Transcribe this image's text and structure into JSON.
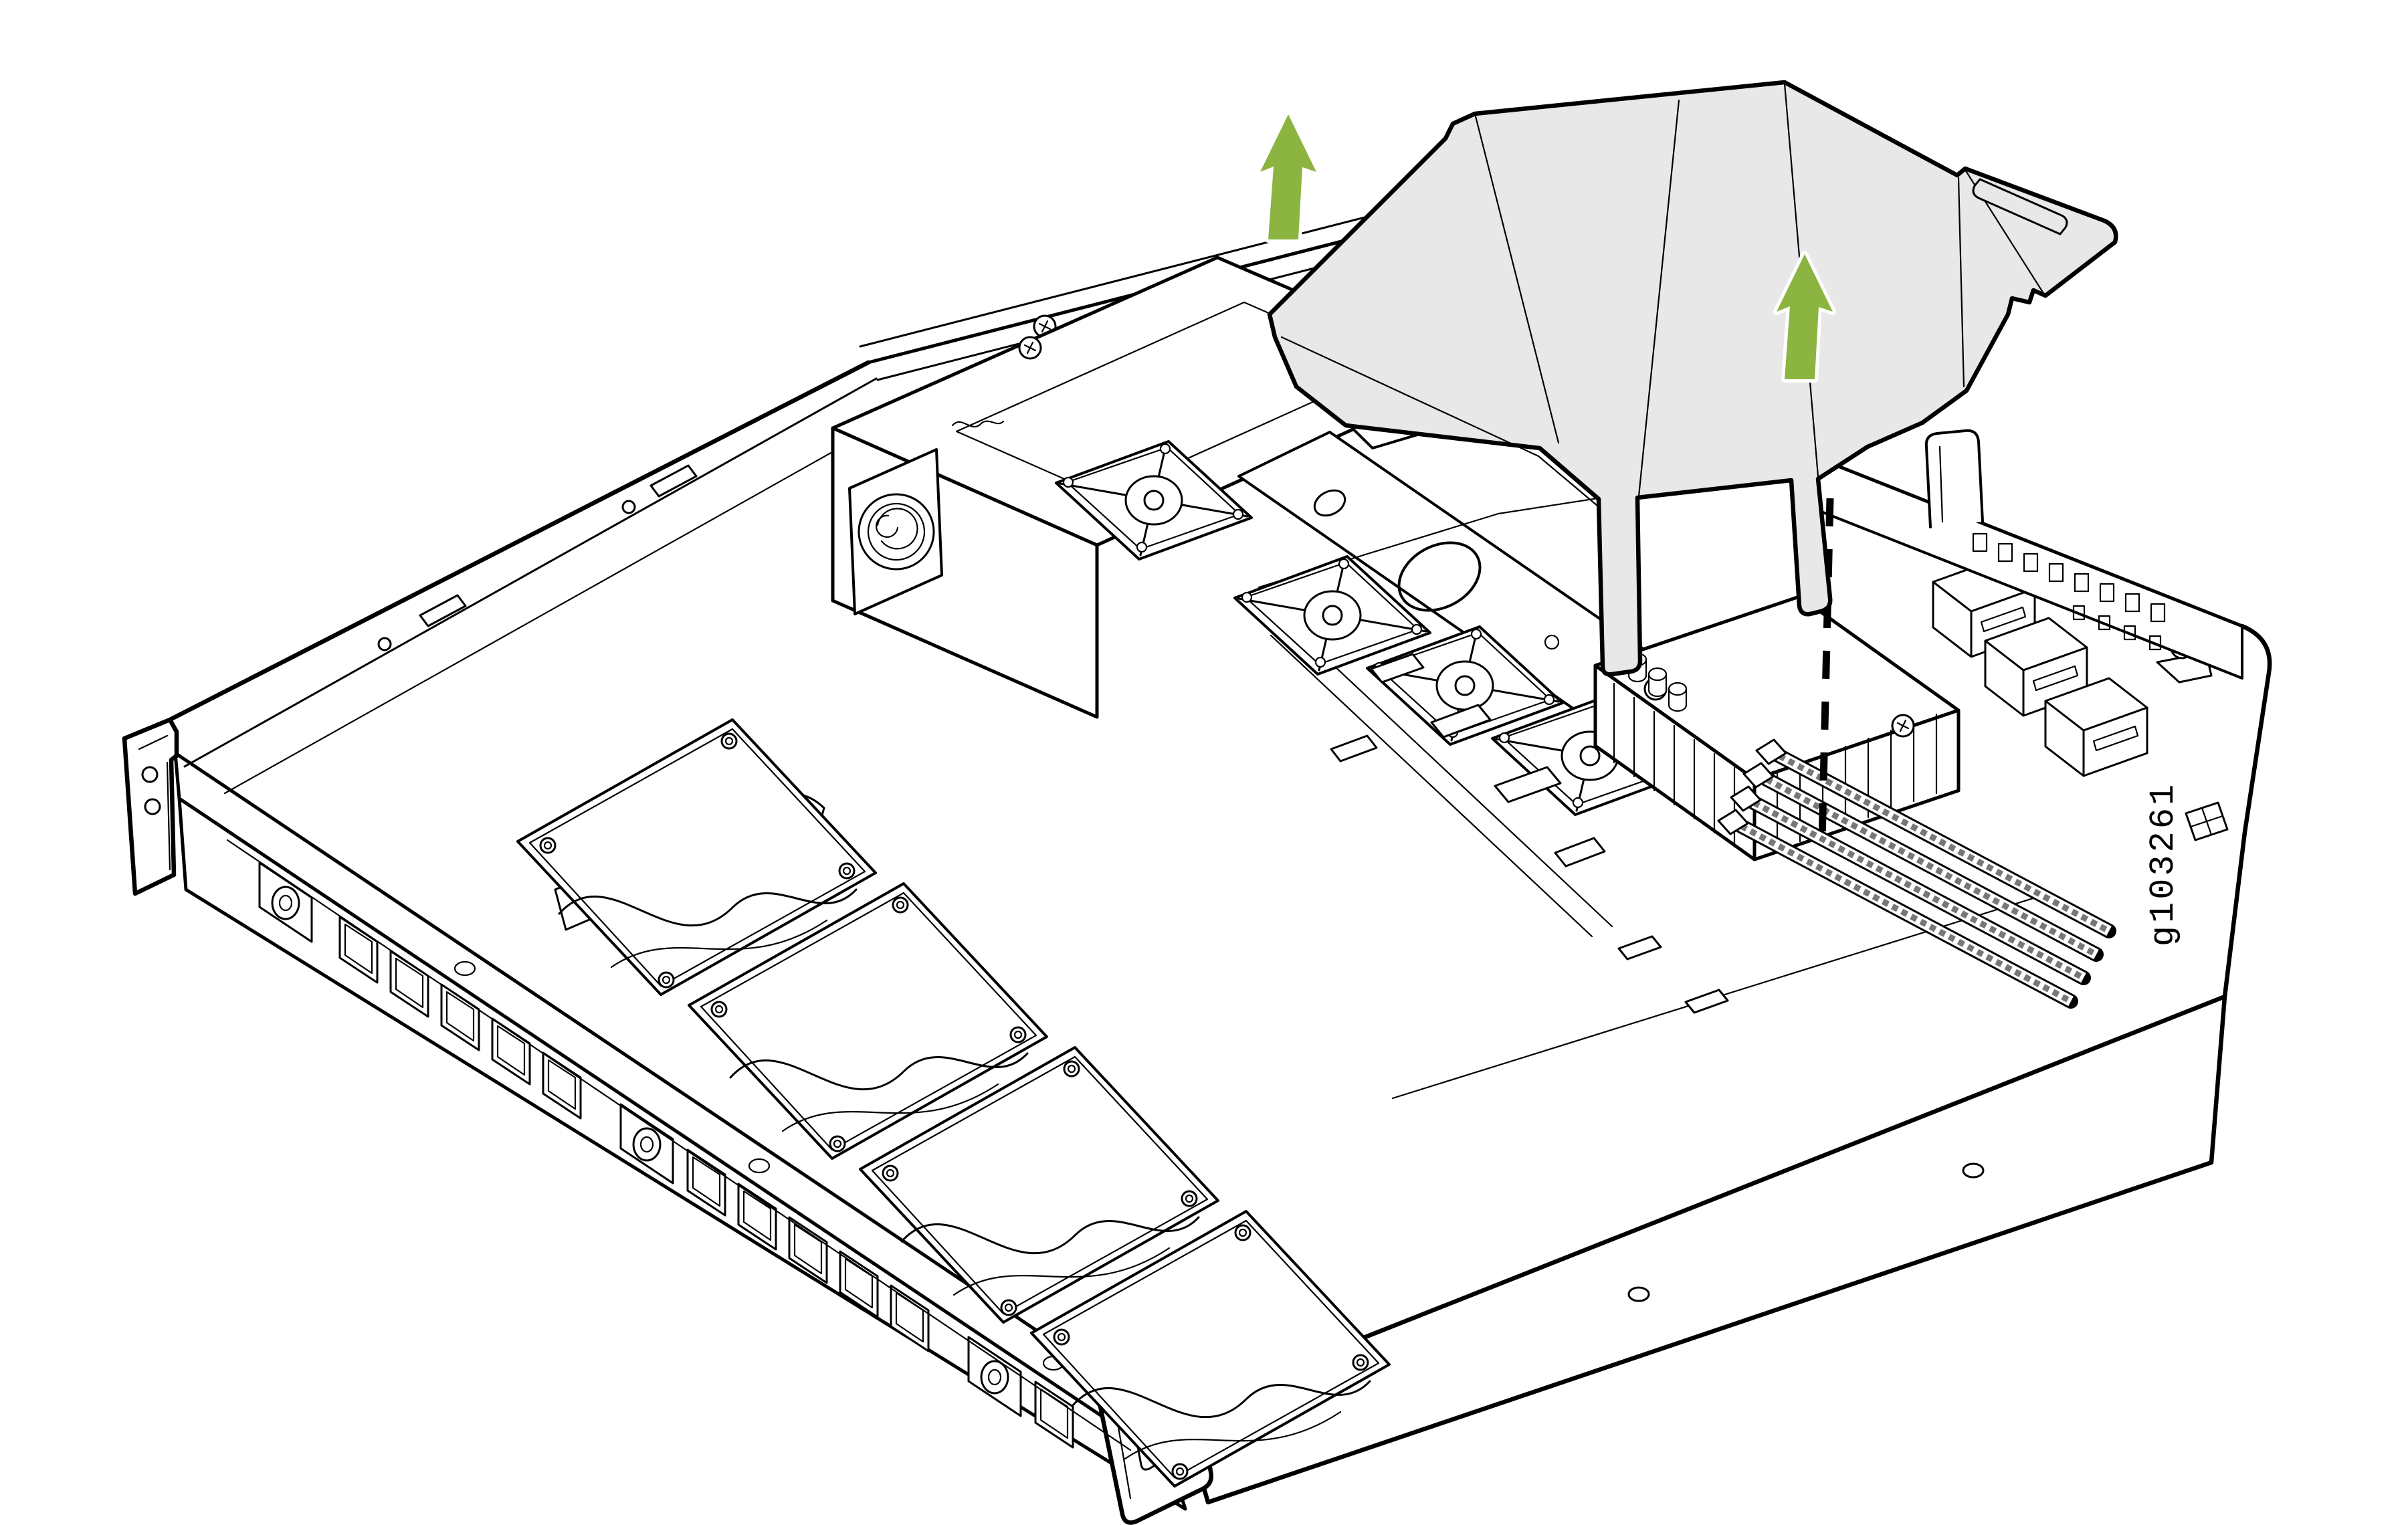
{
  "figure": {
    "id": "g103261",
    "description": "Isometric line illustration of a 1U server chassis with the plastic air shroud lifted out; two green arrows indicate upward removal direction and a dashed line shows the alignment point over the DIMM area."
  },
  "icons": {
    "up_arrow": "↑"
  },
  "colors": {
    "background": "#ffffff",
    "line": "#000000",
    "shroud_fill": "#e8e8e8",
    "arrow_green": "#8cb441",
    "arrow_outline": "#ffffff"
  }
}
